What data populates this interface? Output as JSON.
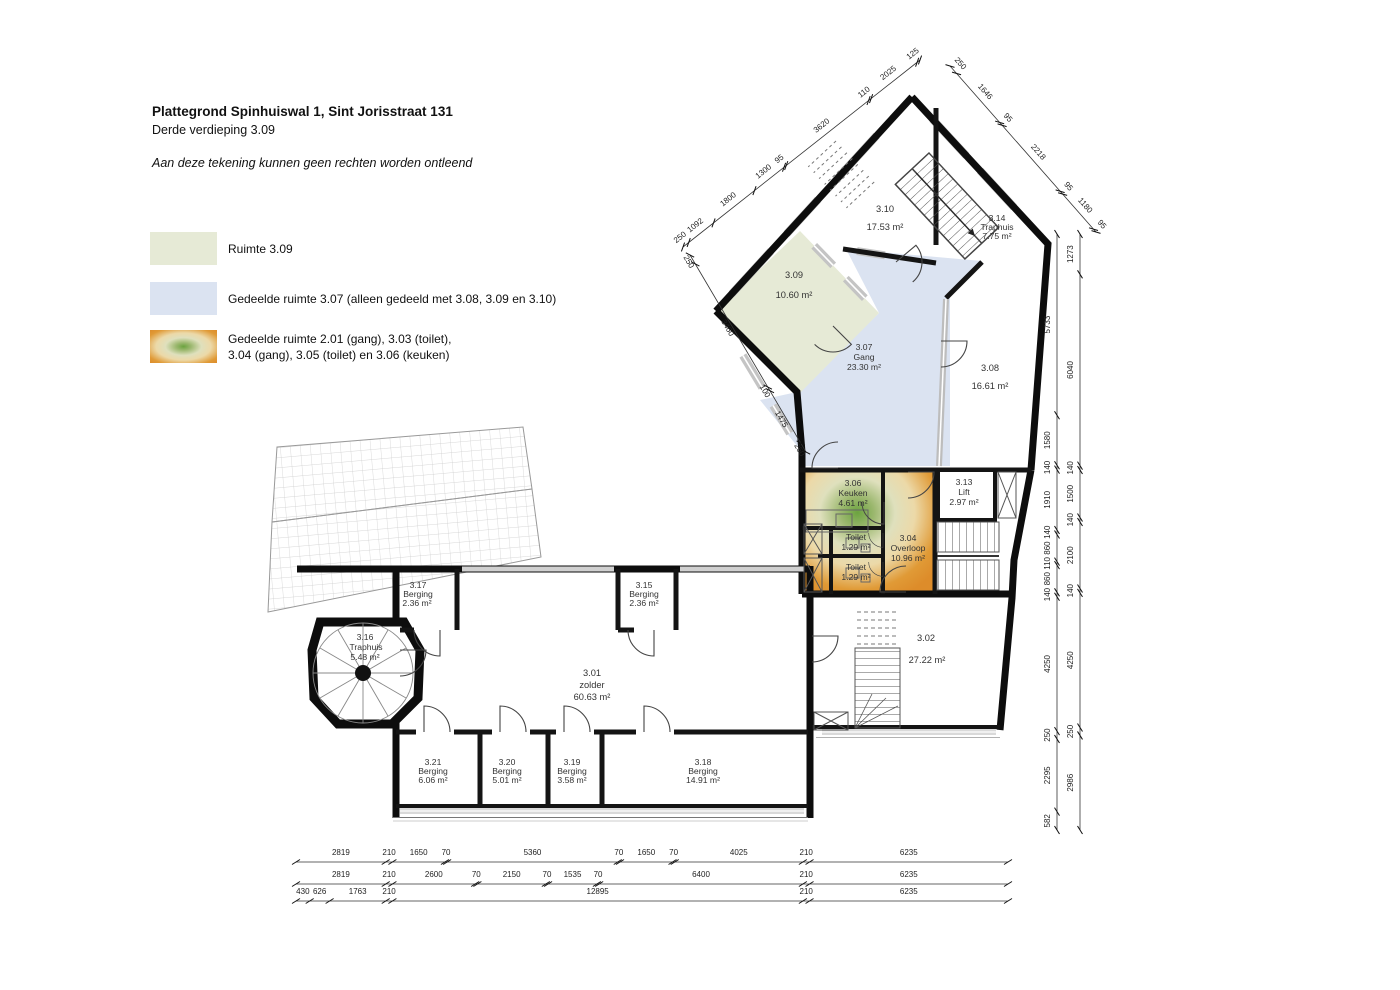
{
  "title": {
    "line1": "Plattegrond Spinhuiswal 1, Sint Jorisstraat 131",
    "line2": "Derde verdieping 3.09",
    "disclaimer": "Aan deze tekening kunnen geen rechten worden ontleend"
  },
  "legend": {
    "items": [
      {
        "label": "Ruimte 3.09",
        "color": "#e6ead6"
      },
      {
        "label": "Gedeelde ruimte 3.07 (alleen gedeeld met 3.08, 3.09 en 3.10)",
        "color": "#dbe3f1"
      },
      {
        "lines": [
          "Gedeelde ruimte 2.01 (gang), 3.03 (toilet),",
          "3.04 (gang), 3.05 (toilet) en 3.06 (keuken)"
        ],
        "color_edge": "#dd8c2a",
        "color_center": "#6ba33f"
      }
    ]
  },
  "plan": {
    "colors": {
      "room_309_fill": "#e6ead6",
      "shared_307_fill": "#dbe3f1",
      "shared_block_edge": "#dd8c2a",
      "shared_block_center": "#6ba33f"
    },
    "rooms": [
      {
        "id": "3.01",
        "name": "zolder",
        "area": "60.63 m²"
      },
      {
        "id": "3.02",
        "name": "",
        "area": "27.22 m²"
      },
      {
        "id": "3.06",
        "name": "Keuken",
        "area": "4.61 m²"
      },
      {
        "id": "",
        "name": "Toilet",
        "area": "1.29 m²"
      },
      {
        "id": "",
        "name": "Toilet",
        "area": "1.29 m²"
      },
      {
        "id": "3.04",
        "name": "Overloop",
        "area": "10.96 m²"
      },
      {
        "id": "3.13",
        "name": "Lift",
        "area": "2.97 m²"
      },
      {
        "id": "3.08",
        "name": "",
        "area": "16.61 m²"
      },
      {
        "id": "3.07",
        "name": "Gang",
        "area": "23.30 m²"
      },
      {
        "id": "3.09",
        "name": "",
        "area": "10.60 m²"
      },
      {
        "id": "3.10",
        "name": "",
        "area": "17.53 m²"
      },
      {
        "id": "3.14",
        "name": "Traphuis",
        "area": "7.75 m²"
      },
      {
        "id": "3.16",
        "name": "Traphuis",
        "area": "5.48 m²"
      },
      {
        "id": "3.17",
        "name": "Berging",
        "area": "2.36 m²"
      },
      {
        "id": "3.15",
        "name": "Berging",
        "area": "2.36 m²"
      },
      {
        "id": "3.21",
        "name": "Berging",
        "area": "6.06 m²"
      },
      {
        "id": "3.20",
        "name": "Berging",
        "area": "5.01 m²"
      },
      {
        "id": "3.19",
        "name": "Berging",
        "area": "3.58 m²"
      },
      {
        "id": "3.18",
        "name": "Berging",
        "area": "14.91 m²"
      }
    ],
    "dims": {
      "bottom_row1": [
        "2819",
        "210",
        "1650",
        "70",
        "5360",
        "70",
        "1650",
        "70",
        "4025",
        "210",
        "6235"
      ],
      "bottom_row2": [
        "2819",
        "210",
        "2600",
        "70",
        "2150",
        "70",
        "1535",
        "70",
        "6400",
        "210",
        "6235"
      ],
      "bottom_row3": [
        "430",
        "626",
        "1763",
        "210",
        "12895",
        "210",
        "6235"
      ],
      "right_inner": [
        "5733",
        "1580",
        "140",
        "1910",
        "140",
        "860",
        "110",
        "860",
        "140",
        "4250",
        "250",
        "2295",
        "582"
      ],
      "right_outer": [
        "1273",
        "6040",
        "140",
        "1500",
        "140",
        "2100",
        "140",
        "4250",
        "250",
        "2986"
      ],
      "diag_top_left": [
        "250",
        "1092",
        "1800",
        "1300",
        "95",
        "3620",
        "110",
        "2025",
        "125"
      ],
      "diag_left": [
        "250",
        "3460",
        "100",
        "1475",
        "250"
      ],
      "diag_top_right": [
        "250",
        "1646",
        "95",
        "2218",
        "95",
        "1180",
        "95"
      ]
    }
  }
}
